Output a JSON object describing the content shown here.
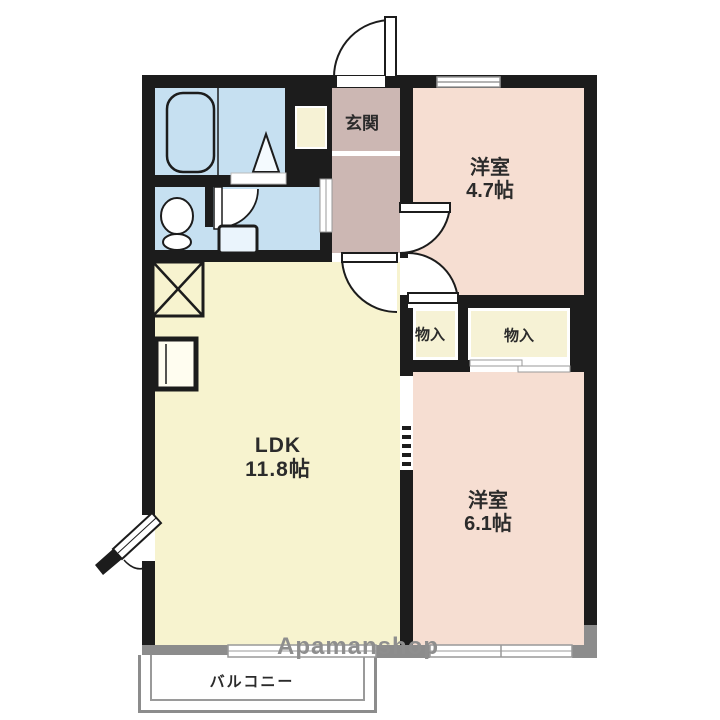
{
  "plan": {
    "genkan": {
      "label": "玄関"
    },
    "room47": {
      "label": "洋室",
      "size": "4.7帖"
    },
    "closet_left": {
      "label": "物入"
    },
    "closet_right": {
      "label": "物入"
    },
    "ldk": {
      "label": "LDK",
      "size": "11.8帖"
    },
    "room61": {
      "label": "洋室",
      "size": "6.1帖"
    },
    "balcony": {
      "label": "バルコニー"
    },
    "watermark": {
      "brand": "Apamanshop"
    },
    "fixtures": [
      "bathtub",
      "shower-triangle",
      "toilet",
      "washbasin",
      "washing-machine-pan",
      "refrigerator-space",
      "entrance-door",
      "hinged-doors",
      "sliding-doors",
      "windows"
    ],
    "colors": {
      "wall": "#1c1c1c",
      "room_pink": "#f6ded2",
      "ldk_cream": "#f7f3cf",
      "wet_area_blue": "#c6e0f1",
      "genkan_mauve": "#ccb7b3",
      "closet_cream": "#f6f2d5",
      "balcony_gray": "#8c8c8c",
      "watermark_gray": "#8e8e8e"
    }
  }
}
